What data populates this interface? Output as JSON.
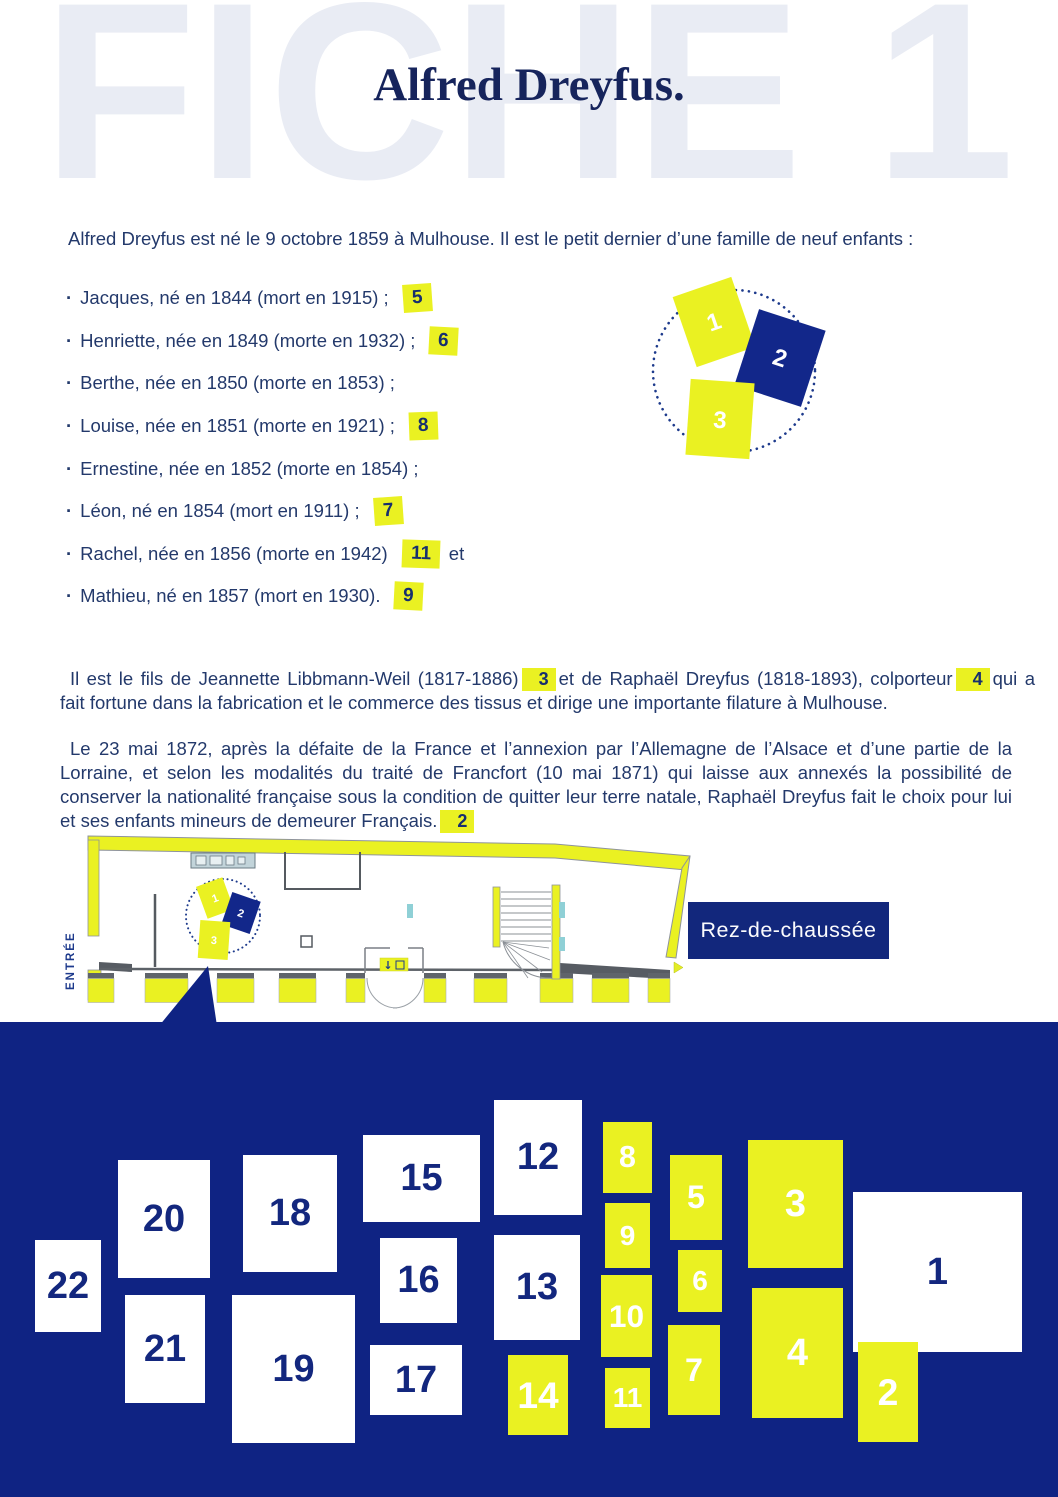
{
  "page": {
    "ghost_title": "FICHE 1",
    "title": "Alfred Dreyfus."
  },
  "intro": "Alfred Dreyfus est né le 9 octobre 1859 à Mulhouse. Il est le petit dernier d’une famille de neuf enfants :",
  "siblings": [
    {
      "text": "Jacques, né en 1844 (mort en 1915) ;",
      "badge": "5",
      "suffix": ""
    },
    {
      "text": "Henriette, née en 1849 (morte en 1932) ;",
      "badge": "6",
      "suffix": ""
    },
    {
      "text": "Berthe, née en 1850 (morte en 1853) ;",
      "badge": "",
      "suffix": ""
    },
    {
      "text": "Louise, née en 1851 (morte en 1921) ;",
      "badge": "8",
      "suffix": ""
    },
    {
      "text": "Ernestine, née en 1852 (morte en 1854) ;",
      "badge": "",
      "suffix": ""
    },
    {
      "text": "Léon, né en 1854 (mort en 1911) ;",
      "badge": "7",
      "suffix": ""
    },
    {
      "text": "Rachel, née en 1856 (morte en 1942)",
      "badge": "11",
      "suffix": "et"
    },
    {
      "text": "Mathieu, né en 1857 (mort en 1930).",
      "badge": "9",
      "suffix": ""
    }
  ],
  "diagram": {
    "cards": [
      {
        "label": "1",
        "color": "yellow"
      },
      {
        "label": "2",
        "color": "navy"
      },
      {
        "label": "3",
        "color": "yellow"
      }
    ]
  },
  "parents_paragraph": {
    "before_badge3": "Il est le fils de Jeannette Libbmann-Weil (1817-1886)",
    "badge3": "3",
    "between": "et de Raphaël Dreyfus (1818-1893), colporteur",
    "badge4": "4",
    "after": "qui a fait fortune dans la fabrication et le commerce des tissus et dirige une importante filature à Mulhouse."
  },
  "treaty_paragraph": {
    "text": "Le 23 mai 1872, après la défaite de la France et l’annexion par l’Allemagne de l’Alsace et d’une partie de la Lorraine, et selon les modalités du traité de Francfort (10 mai 1871) qui laisse aux annexés la possibilité de conserver la nationalité française sous la condition de quitter leur terre natale, Raphaël Dreyfus fait le choix pour lui et ses enfants mineurs de demeurer Français.",
    "badge": "2"
  },
  "floor_plan": {
    "entrance_label": "ENTRÉE",
    "level_label": "Rez-de-chaussée",
    "cards": [
      "1",
      "2",
      "3"
    ],
    "stair_arrow": "↓"
  },
  "map": {
    "tiles": [
      {
        "number": "1",
        "variant": "white"
      },
      {
        "number": "2",
        "variant": "yellow"
      },
      {
        "number": "3",
        "variant": "yellow"
      },
      {
        "number": "4",
        "variant": "yellow"
      },
      {
        "number": "5",
        "variant": "yellow"
      },
      {
        "number": "6",
        "variant": "yellow"
      },
      {
        "number": "7",
        "variant": "yellow"
      },
      {
        "number": "8",
        "variant": "yellow"
      },
      {
        "number": "9",
        "variant": "yellow"
      },
      {
        "number": "10",
        "variant": "yellow"
      },
      {
        "number": "11",
        "variant": "yellow"
      },
      {
        "number": "12",
        "variant": "white"
      },
      {
        "number": "13",
        "variant": "white"
      },
      {
        "number": "14",
        "variant": "yellow"
      },
      {
        "number": "15",
        "variant": "white"
      },
      {
        "number": "16",
        "variant": "white"
      },
      {
        "number": "17",
        "variant": "white"
      },
      {
        "number": "18",
        "variant": "white"
      },
      {
        "number": "19",
        "variant": "white"
      },
      {
        "number": "20",
        "variant": "white"
      },
      {
        "number": "21",
        "variant": "white"
      },
      {
        "number": "22",
        "variant": "white"
      }
    ]
  },
  "colors": {
    "navy_section": "#0f2383",
    "navy_card": "#12278a",
    "yellow": "#eaf122",
    "text_navy": "#23396b",
    "ghost": "#e9ecf4"
  }
}
